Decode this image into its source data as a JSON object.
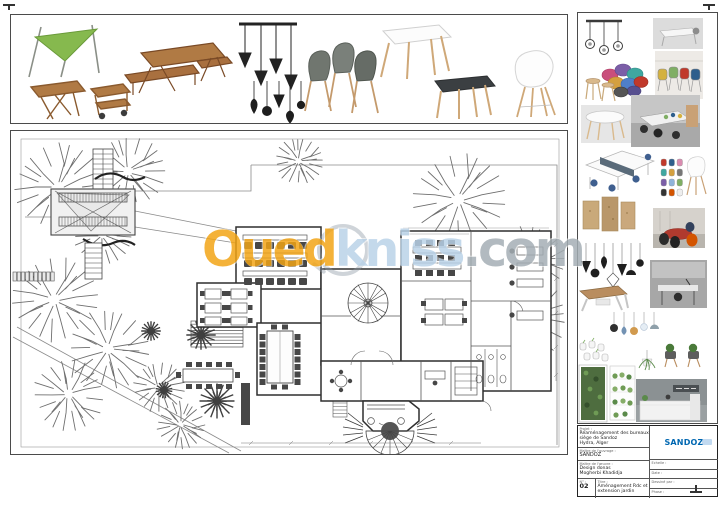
{
  "sheet": {
    "type": "architectural-presentation-board"
  },
  "watermark": {
    "part1": "Oued",
    "part2": "kniss",
    "part3": ".com",
    "color_orange": "#f2a414",
    "color_blue": "#b9d2e8",
    "color_gray": "#a4aeb4"
  },
  "title_block": {
    "project_label": "Projet :",
    "project_line1": "Réaménagement des bureaux siège de Sandoz",
    "project_line2": "Hydra, Alger",
    "client_label": "Maître de l'ouvrage :",
    "client": "SANDOZ",
    "team_label": "Maître de l'œuvre :",
    "team_line1": "Design donas",
    "team_line2": "Mogherbi Khadidja",
    "num_label": "N° :",
    "num": "02",
    "title_label": "Titre :",
    "sheet_title": "Aménagement Rdc et extension jardin",
    "logo_text": "SANDOZ",
    "logo_color": "#0067b1",
    "meta_rows": [
      {
        "label": "Echelle :"
      },
      {
        "label": "Date :"
      },
      {
        "label": "Dessiné par :"
      },
      {
        "label": "Phase :"
      }
    ]
  },
  "top_strip": {
    "items": [
      "shade-sail",
      "folding-table",
      "serving-cart",
      "picnic-table",
      "pendant-lights-row",
      "pendant-lights-cluster",
      "scandinavian-chairs",
      "white-square-table",
      "black-square-table",
      "white-shell-armchair"
    ]
  },
  "sidebar": {
    "items": [
      "industrial-pendant-lamp",
      "desk-photo",
      "colorful-shell-chairs",
      "bean-bag-poufs",
      "wooden-stools",
      "oval-table-photo",
      "open-office-photo",
      "white-workstations",
      "mini-chair-color-grid",
      "white-shell-chair",
      "cork-panels",
      "meeting-room-photo",
      "black-pendant-cluster",
      "wood-top-desk",
      "executive-desk-photo",
      "glass-pendant-lamps",
      "wall-mounted-vases",
      "chairs-with-plants",
      "hanging-planter",
      "living-green-wall",
      "modular-green-wall",
      "reception-desk-photo"
    ]
  },
  "plan": {
    "features": [
      "site-trees",
      "garden-stairs",
      "deck-pergola",
      "driveway",
      "palm-plants",
      "outdoor-dining-table",
      "training-room",
      "meeting-room",
      "conference-room",
      "spiral-staircase",
      "open-space-offices",
      "workstation-cluster",
      "sanitary-block",
      "bay-lounge",
      "fan-terrace",
      "dimension-lines"
    ]
  }
}
